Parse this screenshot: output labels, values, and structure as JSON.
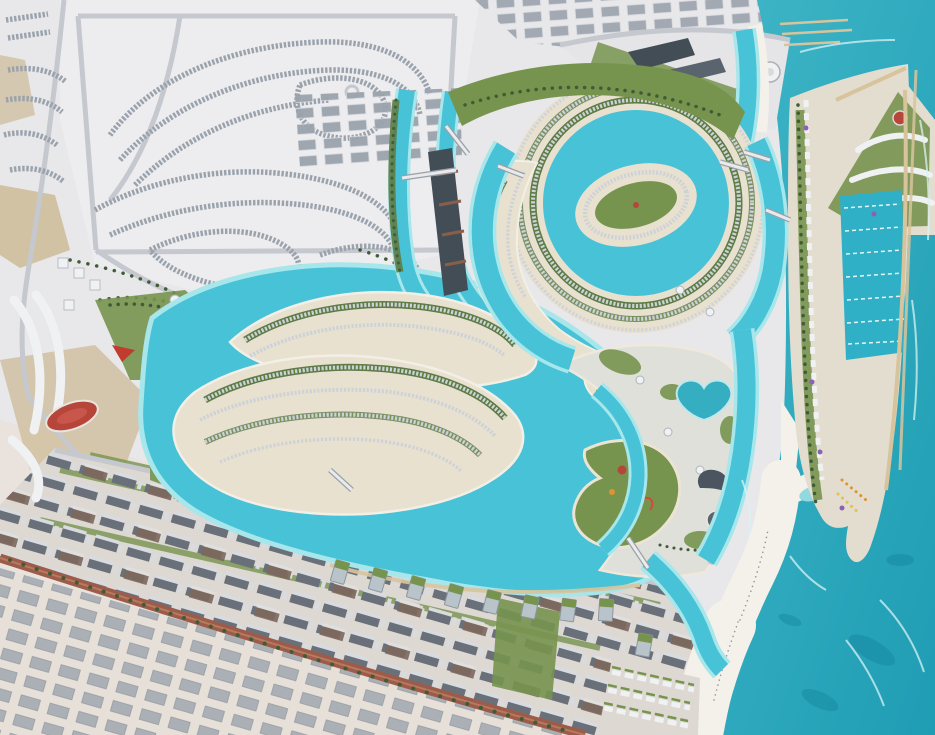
{
  "scene": {
    "kind": "aerial-masterplan-render",
    "regions": {
      "sea": "open sea with beach and breakwater piers",
      "lagoon": "winding turquoise lagoon with spiral island",
      "villa_islands": "curved villa-row islands with sandy rims",
      "marina": "rectangular marina basin with moored boats",
      "desert_suburbs": "pale desert villa community",
      "apartment_district": "diagonal rows of apartment blocks",
      "town_center": "plaza with red oval track and white buildings",
      "waterpark_island": "green comma-shaped island with slides"
    }
  },
  "colors": {
    "ocean1": "#41b7c8",
    "ocean2": "#1f9db4",
    "lagoon": "#47c2d6",
    "lagoon2": "#2fb0c6",
    "shallow": "#a7e6ea",
    "foam": "#d9f2f4",
    "beach": "#f3f1ea",
    "sand": "#e9e1cf",
    "ground": "#e8e7ea",
    "ground2": "#ddd8d2",
    "tan": "#cdbb97",
    "green1": "#5d7c45",
    "green2": "#77944f",
    "greendark": "#3f5c36",
    "villa": "#cdd2d8",
    "villadark": "#9aa2ac",
    "urban": "#a0a7b0",
    "urbanlight": "#d8dbe0",
    "road": "#c5c8ce",
    "redroad": "#9c5c49",
    "slab": "#424d56",
    "roofdark": "#6a7079",
    "glass": "#b9c3ca",
    "navy": "#4a5560",
    "white": "#f0f1f3",
    "red": "#b6453a",
    "orange": "#df9434",
    "yellow": "#e5c14e",
    "purple": "#8e5fb5",
    "tanb": "#d8c49c",
    "pool": "#35aec2"
  }
}
